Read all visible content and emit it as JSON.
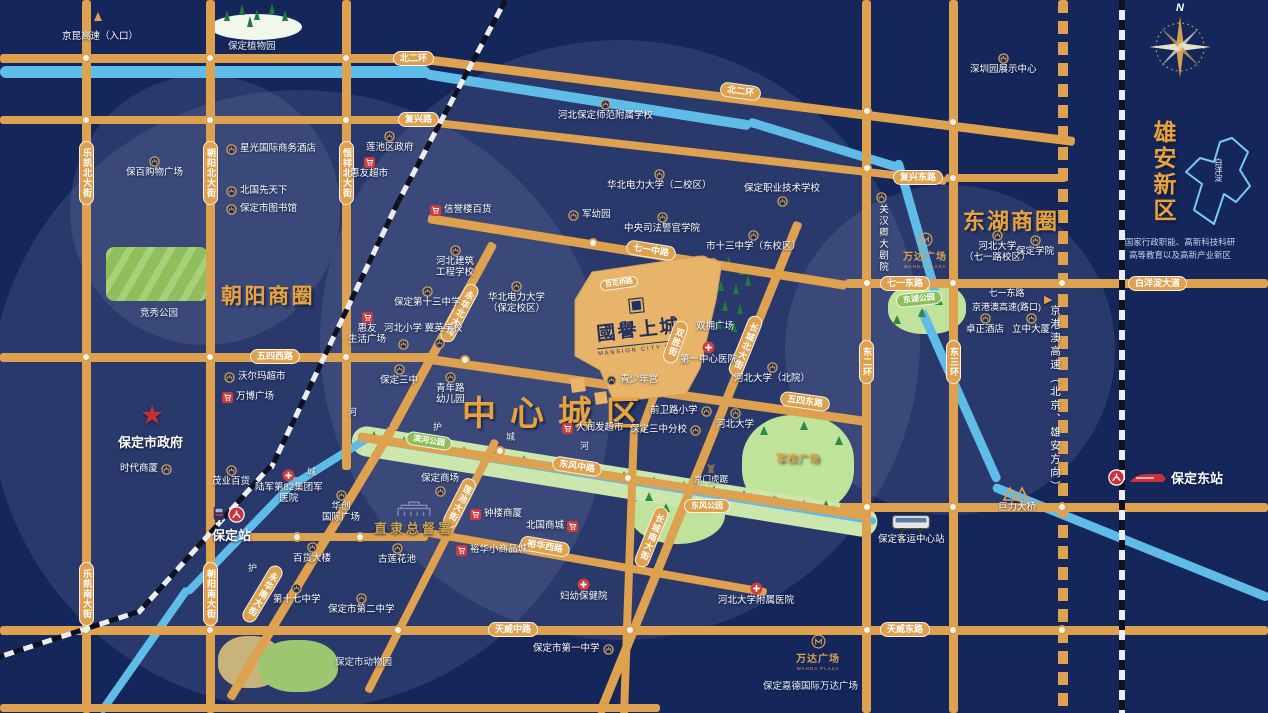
{
  "project": {
    "name": "國譽上城",
    "subtitle": "MANSION CITY ONE"
  },
  "districts": {
    "central": "中心城区",
    "chaoyang": "朝阳商圈",
    "donghu": "东湖商圈",
    "xiongan": "雄安新区",
    "xiongan_desc_1": "国家行政职能、高新科技科研",
    "xiongan_desc_2": "高等教育以及高新产业新区",
    "baiyangdian": "白洋淀"
  },
  "compass": {
    "north": "N"
  },
  "roads": {
    "bei_er_huan": "北二环",
    "bei_er_huan_2": "北二环",
    "fuxing_lu": "复兴路",
    "fuxing_dong_lu": "复兴东路",
    "qiyi_zhong_lu": "七一中路",
    "qiyi_dong_lu": "七一东路",
    "baiyangdian_dadao": "白洋淀大道",
    "wusi_xi_lu": "五四西路",
    "wusi_dong_lu": "五四东路",
    "dongfeng_zhong_lu": "东风中路",
    "yuhua_xi_lu": "裕华西路",
    "tianwei_zhong_lu": "天威中路",
    "tianwei_dong_lu": "天威东路",
    "lekai_bei": "乐凯北大街",
    "lekai_nan": "乐凯南大街",
    "chaoyang_bei": "朝阳北大街",
    "chaoyang_nan": "朝阳南大街",
    "hengxiang_bei": "恒祥北大街",
    "yonghua_bei": "永华北大街",
    "yonghua_nan": "永华南大街",
    "lianchi_dajie": "莲池大街",
    "shuangsheng_jie": "双胜街",
    "changcheng_bei": "长城北大街",
    "changcheng_nan": "长城南大街",
    "dong_er_huan": "东二环",
    "dong_san_huan": "东三环",
    "baihua_qiao_lu": "百花桥路",
    "jinggangao": "京港澳高速（北京、雄安方向）",
    "jingkun_entry": "京昆高速（入口）",
    "expwy_line1": "七一东路",
    "expwy_line2": "京港澳高速(路口)"
  },
  "rivers": {
    "he_a": "河",
    "hu_a": "护",
    "cheng_a": "城",
    "he_b": "河",
    "cheng_b": "城",
    "hu_b": "护"
  },
  "parks": {
    "botanical": "保定植物园",
    "jingxiu": "竞秀公园",
    "binhe": "滨河公园",
    "donghu": "东湖公园",
    "dongfeng": "东风公园",
    "junxiao": "军校广场",
    "zoo": "保定市动物园"
  },
  "stations": {
    "baoding": "保定站",
    "baoding_east": "保定东站",
    "bus_center": "保定客运中心站",
    "juli_bridge": "巨力大桥"
  },
  "wanda": {
    "name": "万达广场",
    "sub": "WANDA PLAZA",
    "jiade": "保定嘉德国际万达广场"
  },
  "pois": {
    "xingguang_hotel": "星光国际商务酒店",
    "baobai_plaza": "保百购物广场",
    "beiguo_xtx": "北国先天下",
    "library": "保定市图书馆",
    "lianchi_gov": "莲池区政府",
    "huiyou_market": "惠友超市",
    "normal_school": "河北保定师范附属学校",
    "ncepu_2": "华北电力大学（二校区）",
    "vocational": "保定职业技术学校",
    "xinyulou": "信誉楼百货",
    "jun_kindergarten": "军幼园",
    "judicial_college": "中央司法警官学院",
    "no13_east": "市十三中学（东校区）",
    "hb_construction_l1": "河北建筑",
    "hb_construction_l2": "工程学校",
    "no13": "保定第十三中学",
    "ncepu_bd_l1": "华北电力大学",
    "ncepu_bd_l2": "（保定校区）",
    "hebei_primary": "河北小学 冀英学校",
    "huiyou_life_l1": "惠友",
    "huiyou_life_l2": "生活广场",
    "no3": "保定三中",
    "youth_kg_l1": "青年路",
    "youth_kg_l2": "幼儿园",
    "youth_palace": "青少年宫",
    "shuangyong": "双拥广场",
    "first_hospital": "第一中心医院",
    "hbu_north": "河北大学（北院）",
    "hbu": "河北大学",
    "qianwei": "前卫路小学",
    "no3_branch": "保定三中分校",
    "rtmart": "大润发超市",
    "jingmen_huju": "京门虎踞",
    "walmart": "沃尔玛超市",
    "wanbo": "万博广场",
    "city_gov": "保定市政府",
    "times_mall": "时代商厦",
    "maoye": "茂业百货",
    "army_hosp_l1": "陆军第82集团军",
    "army_hosp_l2": "医院",
    "huachuang_l1": "华创",
    "huachuang_l2": "国际广场",
    "dept_store": "百货大楼",
    "lotus_pond": "古莲花池",
    "no17": "第十七中学",
    "no2": "保定市第二中学",
    "baoding_mall": "保定商场",
    "governor_office": "直隶总督署",
    "zhonglou": "钟楼商厦",
    "beiguo_mall": "北国商城",
    "yuhua_mall": "裕华小商品城",
    "mch": "妇幼保健院",
    "hbu_hospital": "河北大学附属医院",
    "no1": "保定市第一中学",
    "guanhanqing": "关汉卿大剧院",
    "shenzhen_center": "深圳园展示中心",
    "hbu_71_l1": "河北大学",
    "hbu_71_l2": "（七一路校区）",
    "baoding_college": "保定学院",
    "zhuozheng": "卓正酒店",
    "lizhong": "立中大厦"
  },
  "colors": {
    "background": "#15265B",
    "road": "#DDA14F",
    "river": "#5FBCE9",
    "gold": "#E8A33D",
    "red": "#CE3C3C",
    "green": "#CBE7AD"
  }
}
